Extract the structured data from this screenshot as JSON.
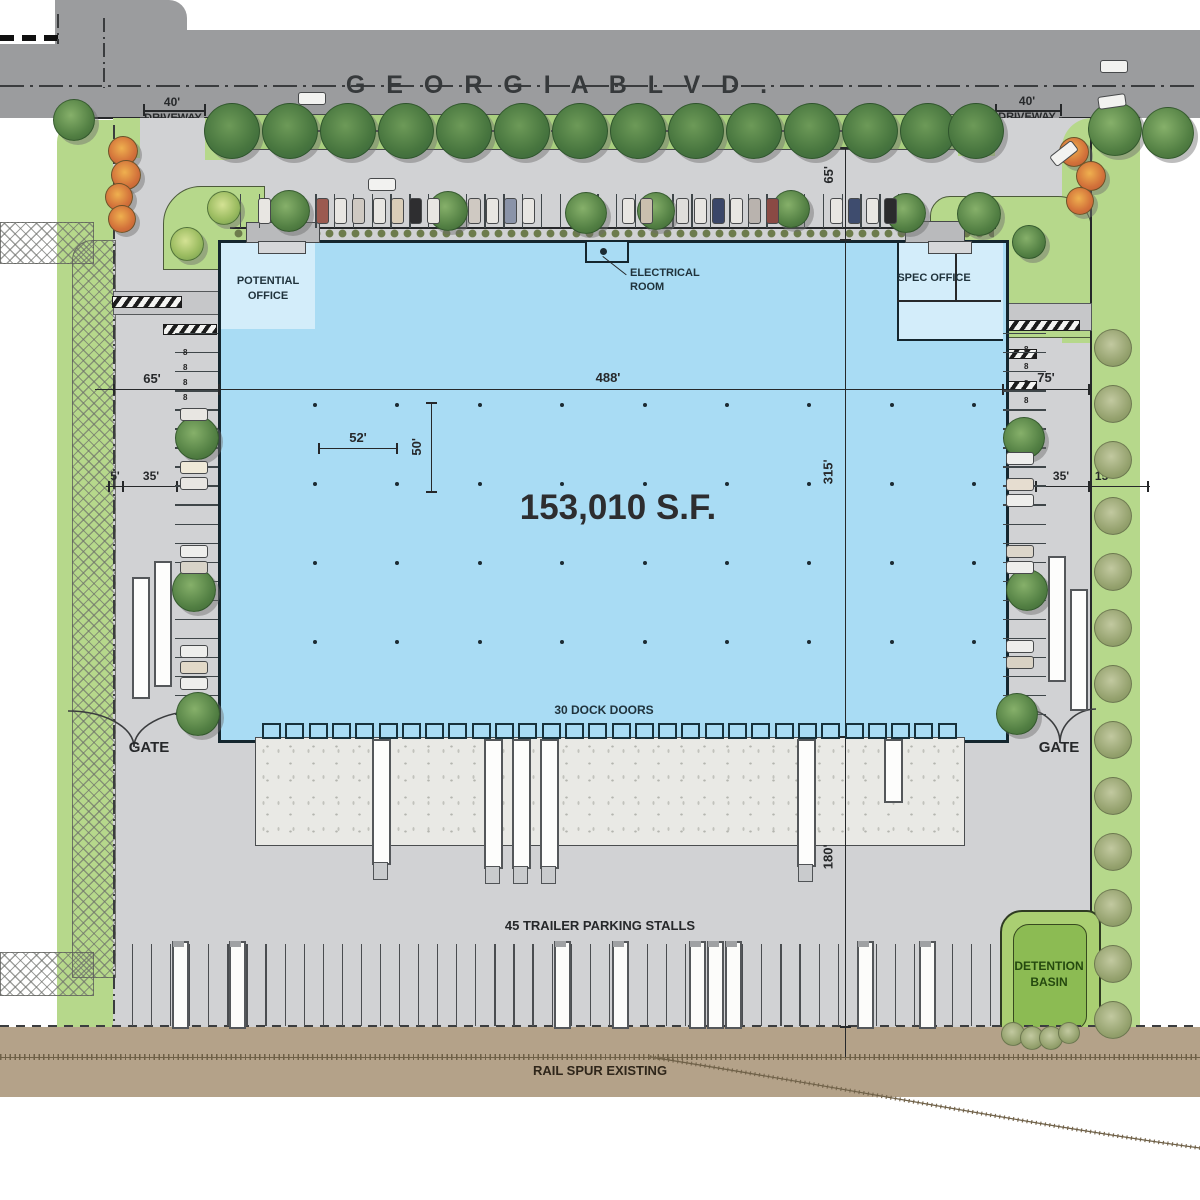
{
  "road": {
    "name": "G E O R G I A     B L V D .",
    "left_driveway_dim": "40'",
    "left_driveway_label": "DRIVEWAY",
    "right_driveway_dim": "40'",
    "right_driveway_label": "DRIVEWAY"
  },
  "building": {
    "area": "153,010 S.F.",
    "potential_office_1": "POTENTIAL",
    "potential_office_2": "OFFICE",
    "electrical_room_1": "ELECTRICAL",
    "electrical_room_2": "ROOM",
    "spec_office": "SPEC OFFICE",
    "dock_doors": "30 DOCK DOORS"
  },
  "dims": {
    "width_488": "488'",
    "depth_315": "315'",
    "front_65": "65'",
    "left_65": "65'",
    "right_75": "75'",
    "bay_52": "52'",
    "bay_50": "50'",
    "left_5": "5'",
    "left_35": "35'",
    "right_35": "35'",
    "right_15": "15'",
    "court_180": "180'"
  },
  "site": {
    "gate_left": "GATE",
    "gate_right": "GATE",
    "trailer": "45 TRAILER PARKING STALLS",
    "detention_1": "DETENTION",
    "detention_2": "BASIN",
    "rail": "RAIL SPUR EXISTING",
    "stall_mark": "8"
  },
  "colors": {
    "road": "#9b9c9e",
    "site_paving": "#d1d2d4",
    "building": "#a9dcf4",
    "office": "#d3edfa",
    "landscape": "#b6d88b",
    "concrete": "#e9e9e5",
    "rail_corridor": "#b4a289",
    "detention_outer": "#aacf72",
    "detention_inner": "#8cbb53"
  }
}
